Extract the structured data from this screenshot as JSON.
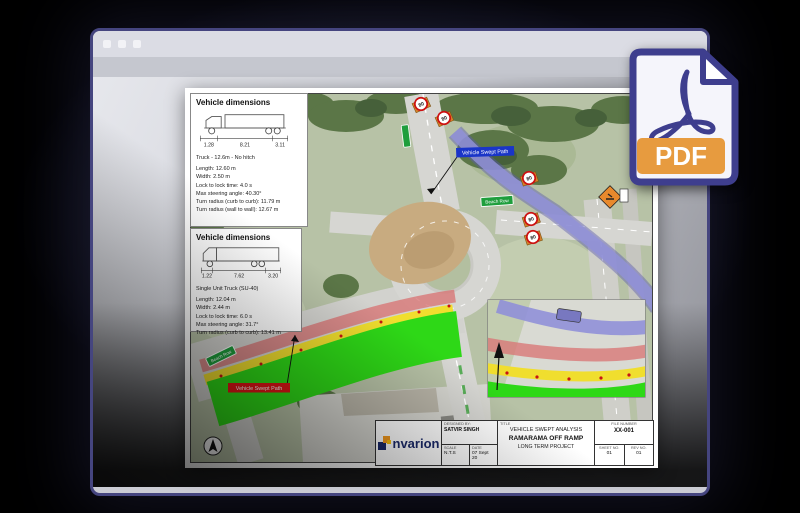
{
  "pdf_badge": {
    "label": "PDF"
  },
  "drawing": {
    "vehicle_box_1": {
      "title": "Vehicle dimensions",
      "dims": [
        "1.28",
        "8.21",
        "3.11"
      ],
      "vehicle_name": "Truck - 12.6m - No hitch",
      "specs": [
        "Length: 12.60 m",
        "Width: 2.50 m",
        "Lock to lock time: 4.0 s",
        "Max steering angle: 40.30°",
        "Turn radius (curb to curb): 11.79 m",
        "Turn radius (wall to wall): 12.67 m"
      ]
    },
    "vehicle_box_2": {
      "title": "Vehicle dimensions",
      "dims": [
        "1.22",
        "7.62",
        "3.20"
      ],
      "vehicle_name": "Single Unit Truck (SU-40)",
      "specs": [
        "Length: 12.04 m",
        "Width: 2.44 m",
        "Lock to lock time: 6.0 s",
        "Max steering angle: 31.7°",
        "Turn radius (curb to curb): 13.41 m"
      ]
    },
    "map": {
      "swept_path_label_blue": "Vehicle Swept Path",
      "swept_path_label_red": "Vehicle Swept Path",
      "road_sign": "Beach Row",
      "road_sign_2": "Beach Row",
      "speed_limit": "80"
    },
    "title_block": {
      "logo_text": "nvarion",
      "designed_by_label": "Designed by:",
      "designed_by": "SATVIR SINGH",
      "scale_label": "SCALE",
      "scale": "N.T.S",
      "date_label": "DATE",
      "date": "07 Sept 20",
      "title_label": "TITLE",
      "title_line1": "VEHICLE SWEPT ANALYSIS",
      "title_line2": "RAMARAMA OFF RAMP",
      "title_line3": "LONG TERM PROJECT",
      "file_number_label": "FILE NUMBER",
      "file_number": "XX-001",
      "sheet_label": "SHEET NO.",
      "sheet": "01",
      "rev_label": "REV NO.",
      "rev": "01"
    }
  },
  "colors": {
    "swept_green": "#2ed817",
    "swept_yellow": "#f0de2e",
    "swept_red": "#d87070",
    "swept_purple": "#9090d8",
    "pdf_indigo": "#3e3e8e",
    "pdf_orange": "#e79b3f"
  }
}
